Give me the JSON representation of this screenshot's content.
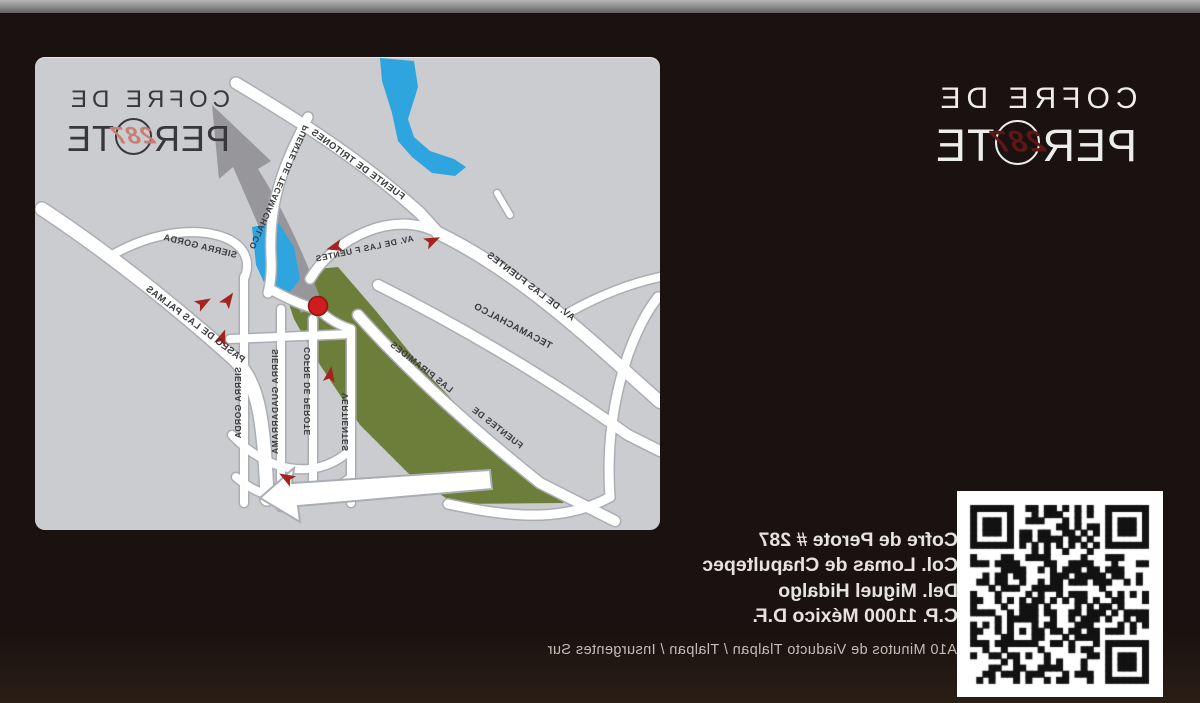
{
  "brand": {
    "line1": "COFRE DE",
    "line2_pre": "PER",
    "line2_post": "TE",
    "number": "287"
  },
  "address": {
    "lines": [
      "Cofre de Perote # 287",
      "Col. Lomas de Chapultepec",
      "Del. Miguel Hidalgo",
      "C.P. 11000 México D.F."
    ],
    "note": "A10 Minutos de Viaducto Tlalpan / Tlalpan / Insurgentes Sur"
  },
  "map": {
    "street_labels": [
      {
        "text": "PASEO DE LAS PALMAS",
        "x": 418,
        "y": 306,
        "rot": -37,
        "size": 9.5
      },
      {
        "text": "SIERRA GORDA",
        "x": 424,
        "y": 201,
        "rot": -14,
        "size": 9
      },
      {
        "text": "PUENTE DE TECAMACHALCO",
        "x": 351,
        "y": 70,
        "rot": 66,
        "size": 8.5
      },
      {
        "text": "FUENTE DE TRITONES",
        "x": 258,
        "y": 143,
        "rot": -36,
        "size": 9.5
      },
      {
        "text": "AV. DE LAS F UENTES",
        "x": 246,
        "y": 184,
        "rot": 12,
        "size": 8.5
      },
      {
        "text": "AV. DE LAS FUENTES",
        "x": 88,
        "y": 264,
        "rot": -37,
        "size": 9.5
      },
      {
        "text": "TECAMACHALCO",
        "x": 110,
        "y": 292,
        "rot": -28,
        "size": 9.5
      },
      {
        "text": "FUENTES DE",
        "x": 140,
        "y": 392,
        "rot": -38,
        "size": 9
      },
      {
        "text": "LAS PIRAMIDES",
        "x": 210,
        "y": 336,
        "rot": -38,
        "size": 9
      },
      {
        "text": "SIERRA GORDA",
        "x": 419,
        "y": 310,
        "rot": 90,
        "size": 8.5
      },
      {
        "text": "SIERRA GUADARRAMA",
        "x": 382,
        "y": 292,
        "rot": 90,
        "size": 8.5
      },
      {
        "text": "COFRE DE PEROTE",
        "x": 350,
        "y": 290,
        "rot": 90,
        "size": 8.5
      },
      {
        "text": "VERTIENTES",
        "x": 312,
        "y": 336,
        "rot": 90,
        "size": 8.5
      }
    ],
    "marker": "location-marker",
    "colors": {
      "panel": "#cbccd0",
      "water": "#2ea5de",
      "park": "#6d7e3b",
      "road_fill": "#ffffff",
      "road_edge": "#a9aeb4",
      "marker_red": "#cf1d1d",
      "arrow_red": "#a3231e",
      "big_arrow_gray": "#96969b",
      "label_ink": "#3a3a3e"
    }
  },
  "page_colors": {
    "background": "#1a1210",
    "topbar": "#8a8a8a",
    "brand_number_dark": "#5e1717",
    "brand_number_map": "#c97f70"
  }
}
